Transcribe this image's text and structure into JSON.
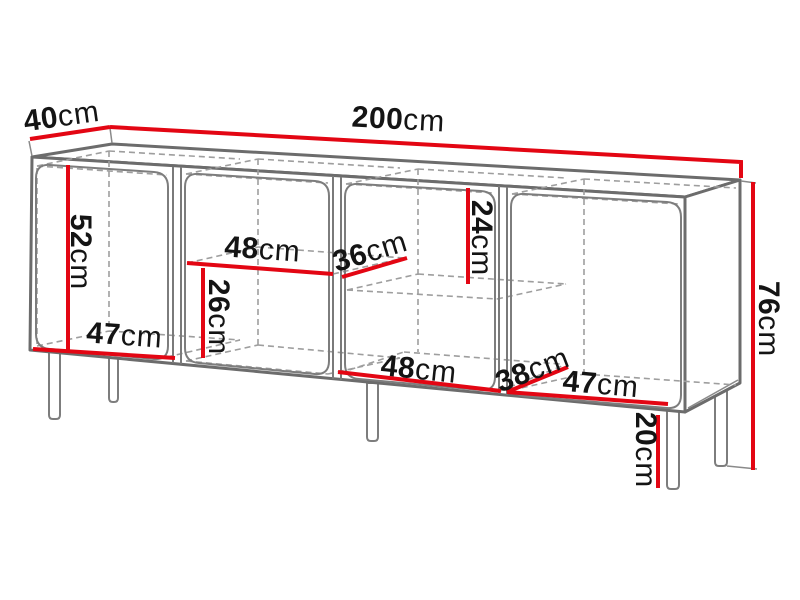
{
  "diagram": {
    "type": "furniture-dimension-drawing",
    "object": "sideboard with four compartments, two shelves and five legs",
    "unit": "cm",
    "colors": {
      "dimension_line": "#e30613",
      "outline": "#6c6c6c",
      "hidden_line": "#9e9e9e",
      "label_text": "#141414",
      "background": "#ffffff"
    },
    "dims": [
      {
        "id": "top-depth",
        "value": "40",
        "unit": "cm"
      },
      {
        "id": "top-width",
        "value": "200",
        "unit": "cm"
      },
      {
        "id": "overall-height",
        "value": "76",
        "unit": "cm"
      },
      {
        "id": "compartment1-interior-height",
        "value": "52",
        "unit": "cm"
      },
      {
        "id": "compartment1-interior-width",
        "value": "47",
        "unit": "cm"
      },
      {
        "id": "compartment2-shelf-width",
        "value": "48",
        "unit": "cm"
      },
      {
        "id": "compartment2-shelf-depth",
        "value": "36",
        "unit": "cm"
      },
      {
        "id": "compartment3-upper-height",
        "value": "24",
        "unit": "cm"
      },
      {
        "id": "compartment2-lower-height",
        "value": "26",
        "unit": "cm"
      },
      {
        "id": "compartment3-interior-width",
        "value": "48",
        "unit": "cm"
      },
      {
        "id": "compartment4-interior-depth",
        "value": "38",
        "unit": "cm"
      },
      {
        "id": "compartment4-interior-width",
        "value": "47",
        "unit": "cm"
      },
      {
        "id": "leg-height",
        "value": "20",
        "unit": "cm"
      }
    ]
  }
}
